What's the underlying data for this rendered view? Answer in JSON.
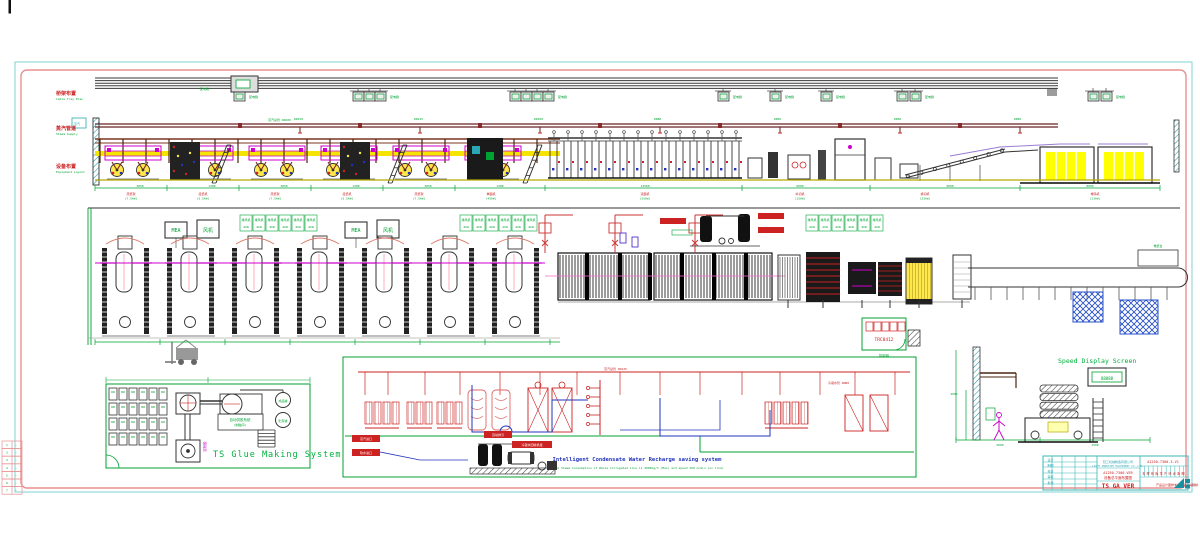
{
  "sheet": {
    "side_labels": [
      {
        "cn": "桥架布置",
        "en": "Cable Tray Plan"
      },
      {
        "cn": "蒸汽管道",
        "en": "Steam Supply"
      },
      {
        "cn": "设备布置",
        "en": "Equipment Layout"
      }
    ],
    "steam_tag": "蒸汽"
  },
  "top_band": {
    "power_box_label": "配电箱",
    "pipe_main_label": "蒸汽总管 DN200",
    "pipe_drop_labels": [
      "DN150",
      "DN125",
      "DN100",
      "DN80",
      "DN65",
      "DN50",
      "DN40"
    ],
    "station_labels": [
      {
        "x": 131,
        "a": "原纸架",
        "b": "(7.5kW)"
      },
      {
        "x": 203,
        "a": "接纸机",
        "b": "(5.5kW)"
      },
      {
        "x": 275,
        "a": "原纸架",
        "b": "(7.5kW)"
      },
      {
        "x": 347,
        "a": "接纸机",
        "b": "(5.5kW)"
      },
      {
        "x": 419,
        "a": "原纸架",
        "b": "(7.5kW)"
      },
      {
        "x": 491,
        "a": "单面机",
        "b": "(45kW)"
      },
      {
        "x": 645,
        "a": "双面机",
        "b": "(55kW)"
      },
      {
        "x": 800,
        "a": "纵切机",
        "b": "(15kW)"
      },
      {
        "x": 925,
        "a": "横切机",
        "b": "(22kW)"
      },
      {
        "x": 1095,
        "a": "堆码机",
        "b": "(11kW)"
      }
    ],
    "dim_labels": [
      {
        "x": 140,
        "t": "3050"
      },
      {
        "x": 212,
        "t": "1380"
      },
      {
        "x": 284,
        "t": "3050"
      },
      {
        "x": 356,
        "t": "1380"
      },
      {
        "x": 428,
        "t": "3050"
      },
      {
        "x": 500,
        "t": "1380"
      },
      {
        "x": 645,
        "t": "13500"
      },
      {
        "x": 800,
        "t": "6000"
      },
      {
        "x": 950,
        "t": "9000"
      },
      {
        "x": 1090,
        "t": "8000"
      }
    ]
  },
  "mid_band": {
    "fan_box_labels": [
      "MEA",
      "风机"
    ],
    "cell_label": "排风机",
    "cell_sub": "4kW",
    "control_code": "TRC8412",
    "control_label": "控制柜",
    "right_label": "堆纸台"
  },
  "glue": {
    "title": "TS Glue Making System",
    "room": "自动供胶系统",
    "room_sub": "(制胶间)",
    "shaft_note": "淀粉胶",
    "tank1": "成品罐",
    "tank2": "贮存罐"
  },
  "schematic": {
    "title": "Intelligent Condensate Water Recharge saving system",
    "subtitle": "Total Steam Consumption of Whole Corrugated Line is 4000kg/h (Max) and speed 250 m/min (on line)",
    "tag_steam_in": "蒸汽进口",
    "tag_water_in": "软水进口",
    "tag_blowdown": "自动排污",
    "tag_unit": "冷凝水回收机组",
    "pipe_note1": "蒸汽总管 DN125",
    "pipe_note2": "冷凝水管 DN80"
  },
  "speed": {
    "title": "Speed Display Screen",
    "value": "88888",
    "dim1": "5000",
    "dim2": "1500",
    "dim_h": "2600"
  },
  "title_block": {
    "company_cn": "轻工机械制造有限公司",
    "company_en": "LIGHT INDUSTRY MACHINERY CO.,LTD.",
    "doc_no": "A1250-7300-VER",
    "doc_title": "设备总平面布置图",
    "big_code": "TS GA VER",
    "drawing_no": "A1250-7300-3-V1",
    "cell_chars": "瓦楞纸板生产线设备图",
    "footer": "产品设计图样未经许可不得翻制",
    "logo": "KS",
    "row_labels": [
      "设计",
      "制图",
      "校对",
      "审核",
      "批准"
    ]
  },
  "rev_table": {
    "rows": [
      "1",
      "2",
      "3",
      "4",
      "5",
      "6",
      "7"
    ]
  }
}
